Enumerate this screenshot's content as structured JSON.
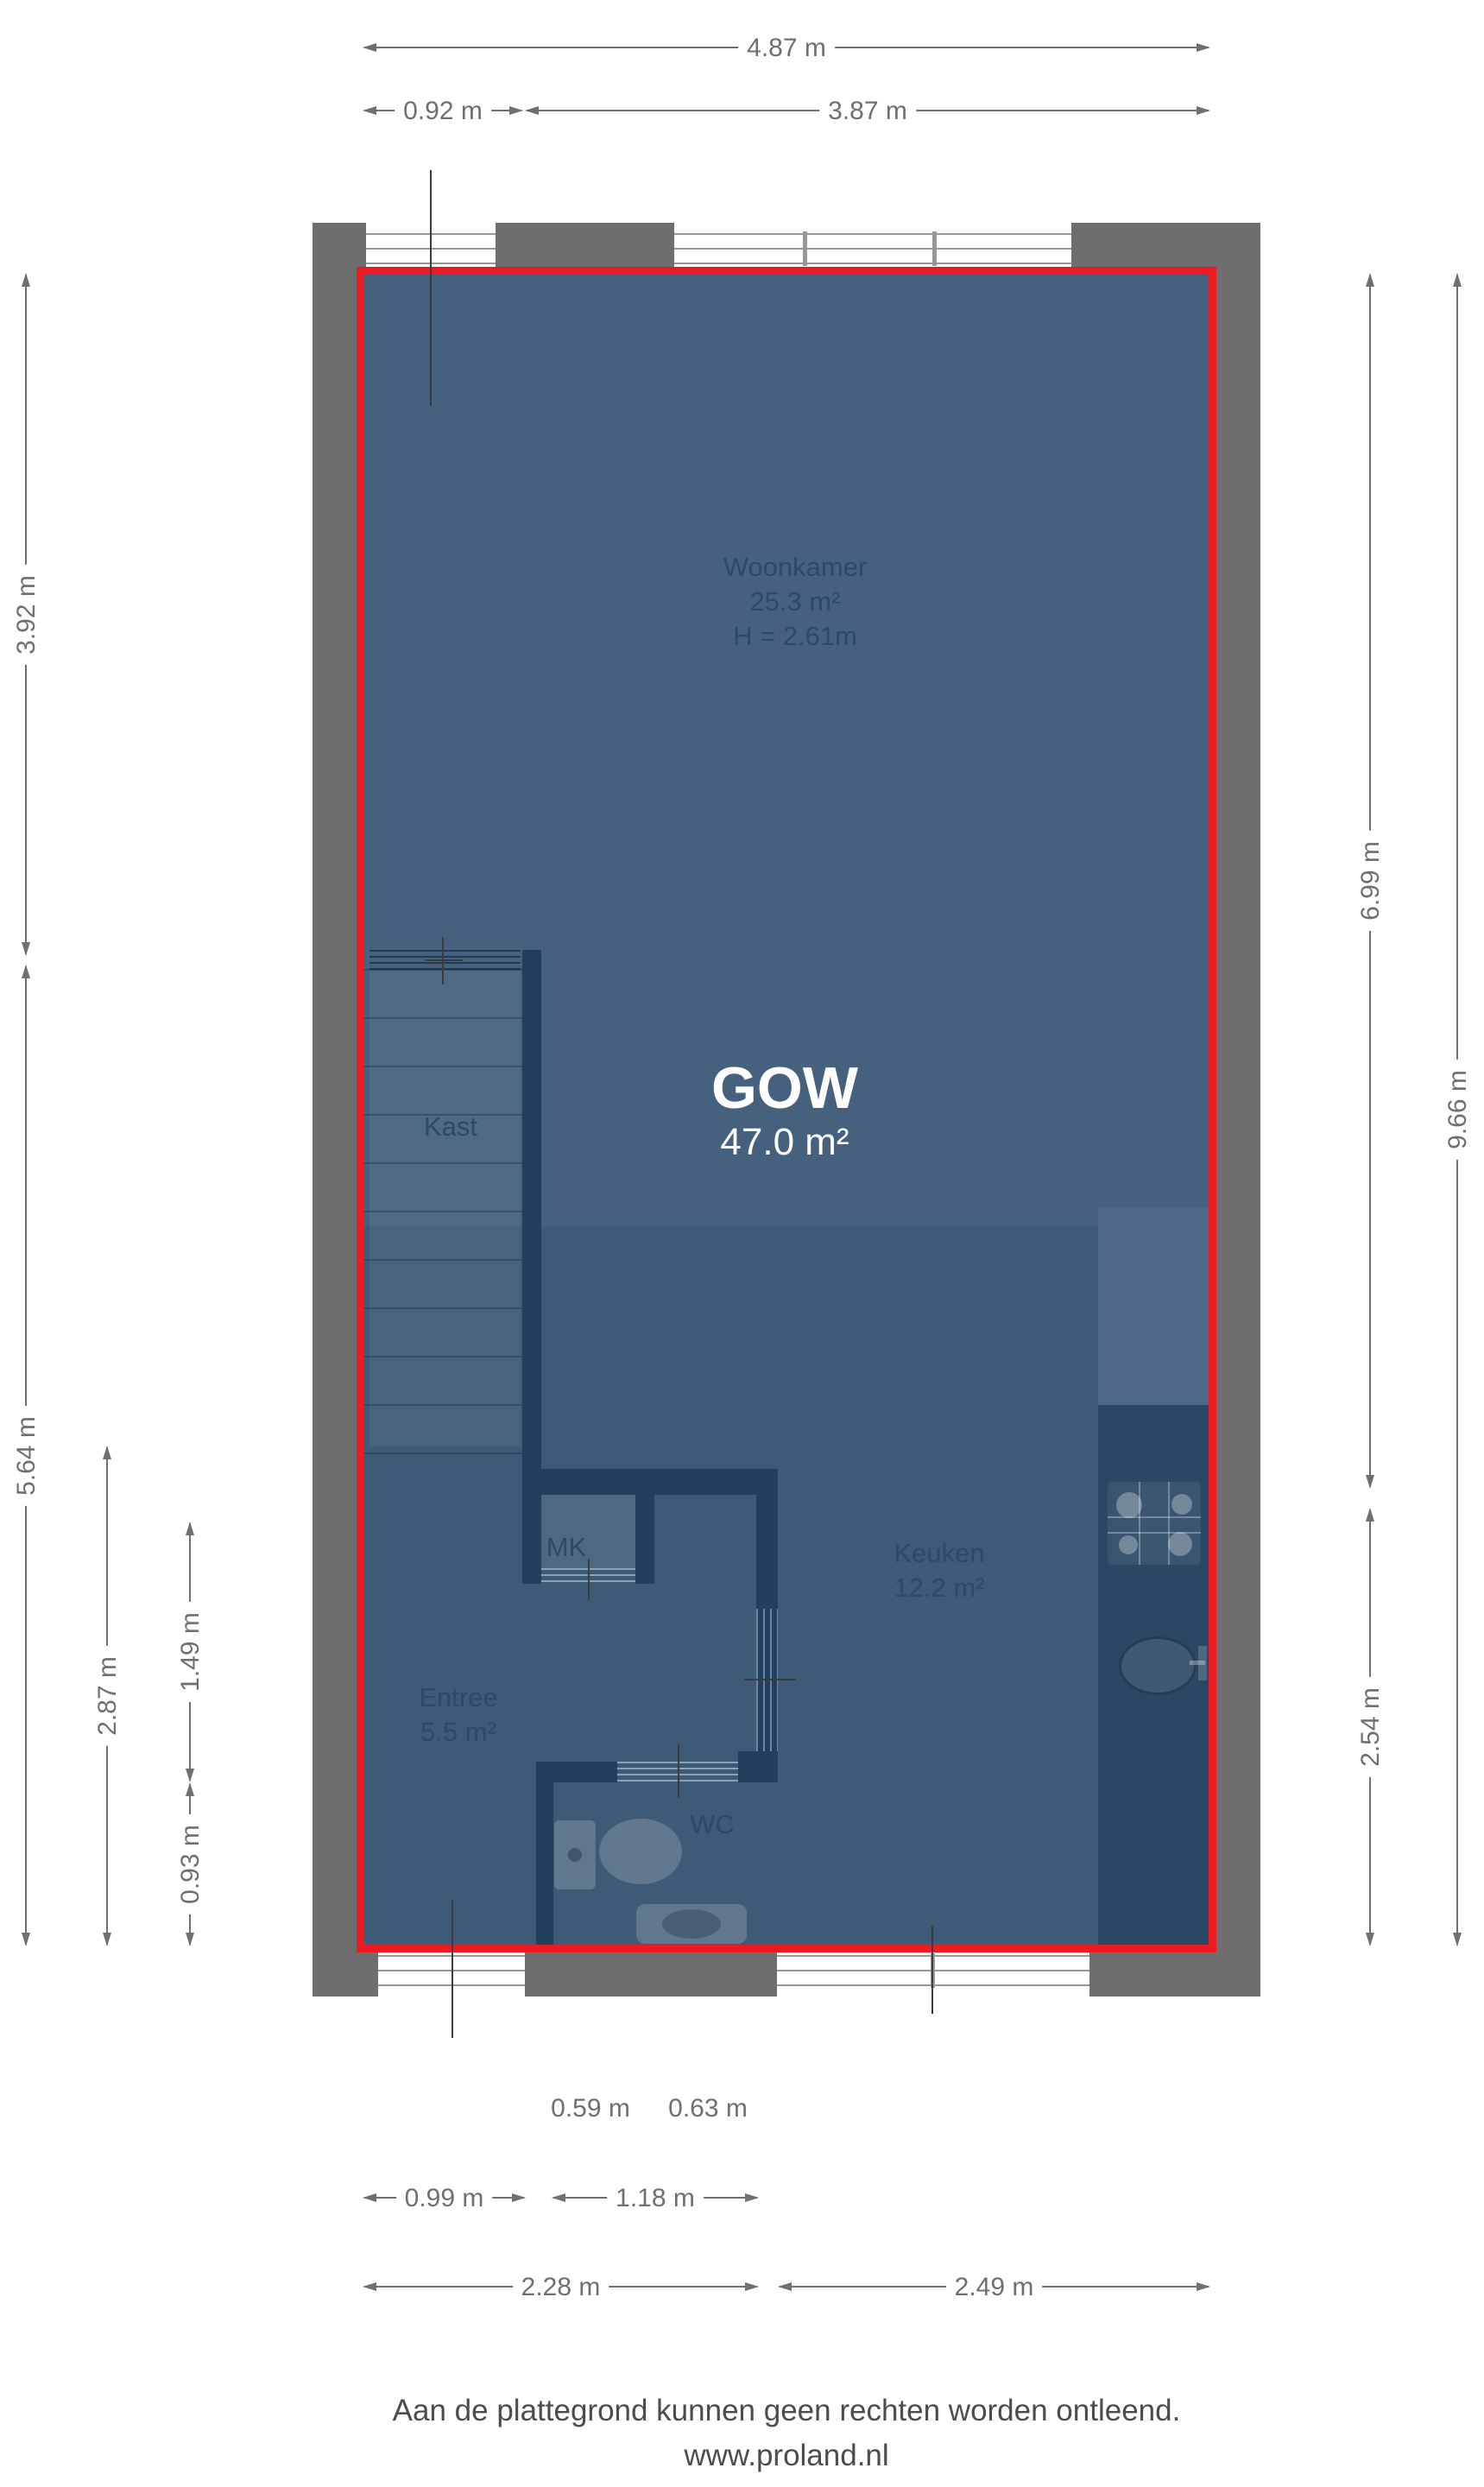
{
  "plan": {
    "rooms": {
      "woonkamer": {
        "name": "Woonkamer",
        "area": "25.3 m²",
        "height": "H = 2.61m"
      },
      "gow": {
        "name": "GOW",
        "area": "47.0 m²"
      },
      "kast": {
        "name": "Kast"
      },
      "mk": {
        "name": "MK"
      },
      "entree": {
        "name": "Entree",
        "area": "5.5 m²"
      },
      "wc": {
        "name": "WC"
      },
      "keuken": {
        "name": "Keuken",
        "area": "12.2 m²"
      }
    },
    "dimensions": {
      "top": [
        "4.87 m",
        "0.92 m",
        "3.87 m"
      ],
      "left": [
        "3.92 m",
        "5.64 m",
        "2.87 m",
        "1.49 m",
        "0.93 m"
      ],
      "right": [
        "6.99 m",
        "9.66 m",
        "2.54 m"
      ],
      "bottom": [
        "0.59 m",
        "0.63 m",
        "0.99 m",
        "1.18 m",
        "2.28 m",
        "2.49 m"
      ]
    },
    "colors": {
      "wall_gray": "#6e6e6e",
      "interior_wall_navy": "#21405e",
      "floor_upper": "#45617d",
      "floor_lower": "#3d5a76",
      "kitchen_counter": "#2a4763",
      "outline_red": "#ec1b23",
      "dimension_gray": "#6f6f6f",
      "room_text": "#2a4a68"
    },
    "footer": {
      "line1": "Aan de plattegrond kunnen geen rechten worden ontleend.",
      "line2": "www.proland.nl"
    }
  }
}
